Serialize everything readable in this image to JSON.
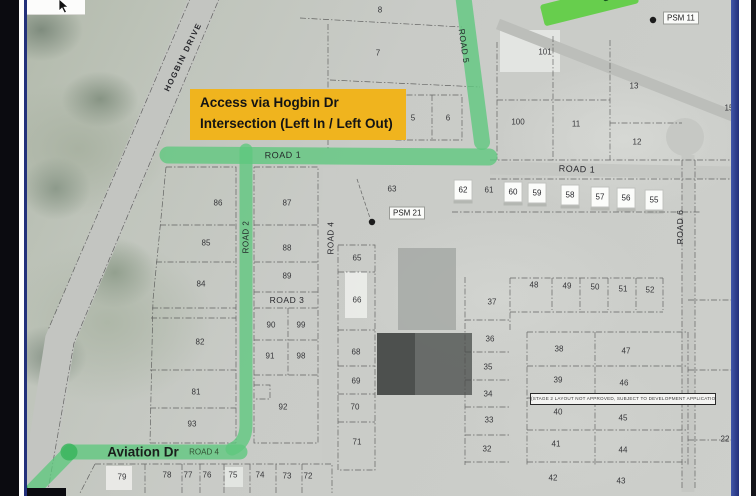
{
  "colors": {
    "highlight_green": "#5EC87D",
    "highlight_green_dark": "#3DB55F",
    "sign_green": "#67CE4D",
    "callout_bg": "#F0B41E",
    "frame_navy": "#22307A"
  },
  "callout": {
    "line1": "Access via Hogbin Dr",
    "line2": "Intersection (Left In / Left Out)"
  },
  "street_sign": {
    "visible_text": "s Rd"
  },
  "note": {
    "text": "(STAGE 2 LAYOUT NOT APPROVED, SUBJECT TO DEVELOPMENT APPLICATION)"
  },
  "map": {
    "road_labels": [
      {
        "text": "HOGBIN DRIVE",
        "x": 183,
        "y": 57,
        "rot": -64,
        "size": 8,
        "weight": 700,
        "ls": 1.4
      },
      {
        "text": "ROAD 5",
        "x": 464,
        "y": 46,
        "rot": 82,
        "size": 8.5,
        "ls": 0.5
      },
      {
        "text": "ROAD 1",
        "x": 283,
        "y": 155,
        "rot": -1,
        "size": 9,
        "ls": 0.5
      },
      {
        "text": "ROAD 1",
        "x": 577,
        "y": 169,
        "rot": 2,
        "size": 9,
        "ls": 0.5
      },
      {
        "text": "ROAD 2",
        "x": 246,
        "y": 237,
        "rot": -90,
        "size": 8,
        "ls": 0.5
      },
      {
        "text": "ROAD 4",
        "x": 331,
        "y": 238,
        "rot": -90,
        "size": 8,
        "ls": 0.5
      },
      {
        "text": "ROAD 3",
        "x": 287,
        "y": 300,
        "rot": 0,
        "size": 8.5,
        "ls": 0.5
      },
      {
        "text": "ROAD 6",
        "x": 680,
        "y": 227,
        "rot": -90,
        "size": 8.5,
        "ls": 0.5
      },
      {
        "text": "Aviation Dr",
        "x": 143,
        "y": 452,
        "rot": 0,
        "size": 13.5,
        "weight": 600,
        "color": "#161616"
      },
      {
        "text": "ROAD 4",
        "x": 204,
        "y": 452,
        "rot": 0,
        "size": 8,
        "color": "#2f4a2f"
      }
    ],
    "psm_markers": [
      {
        "label": "PSM 11",
        "x": 663,
        "y": 18
      },
      {
        "label": "PSM 21",
        "x": 389,
        "y": 213
      }
    ],
    "lots": [
      {
        "n": "8",
        "x": 380,
        "y": 10
      },
      {
        "n": "7",
        "x": 378,
        "y": 53
      },
      {
        "n": "5",
        "x": 413,
        "y": 118
      },
      {
        "n": "6",
        "x": 448,
        "y": 118
      },
      {
        "n": "101",
        "x": 545,
        "y": 52
      },
      {
        "n": "13",
        "x": 634,
        "y": 86
      },
      {
        "n": "100",
        "x": 518,
        "y": 122
      },
      {
        "n": "11",
        "x": 576,
        "y": 124
      },
      {
        "n": "12",
        "x": 637,
        "y": 142
      },
      {
        "n": "15",
        "x": 729,
        "y": 108
      },
      {
        "n": "63",
        "x": 392,
        "y": 189
      },
      {
        "n": "62",
        "x": 463,
        "y": 190,
        "boxed": true
      },
      {
        "n": "61",
        "x": 489,
        "y": 190
      },
      {
        "n": "60",
        "x": 513,
        "y": 192,
        "boxed": true
      },
      {
        "n": "59",
        "x": 537,
        "y": 193,
        "boxed": true
      },
      {
        "n": "58",
        "x": 570,
        "y": 195,
        "boxed": true
      },
      {
        "n": "57",
        "x": 600,
        "y": 197,
        "boxed": true
      },
      {
        "n": "56",
        "x": 626,
        "y": 198,
        "boxed": true
      },
      {
        "n": "55",
        "x": 654,
        "y": 200,
        "boxed": true
      },
      {
        "n": "86",
        "x": 218,
        "y": 203
      },
      {
        "n": "87",
        "x": 287,
        "y": 203
      },
      {
        "n": "85",
        "x": 206,
        "y": 243
      },
      {
        "n": "88",
        "x": 287,
        "y": 248
      },
      {
        "n": "84",
        "x": 201,
        "y": 284
      },
      {
        "n": "89",
        "x": 287,
        "y": 276
      },
      {
        "n": "82",
        "x": 200,
        "y": 342
      },
      {
        "n": "90",
        "x": 271,
        "y": 325
      },
      {
        "n": "99",
        "x": 301,
        "y": 325
      },
      {
        "n": "91",
        "x": 270,
        "y": 356
      },
      {
        "n": "98",
        "x": 301,
        "y": 356
      },
      {
        "n": "81",
        "x": 196,
        "y": 392
      },
      {
        "n": "92",
        "x": 283,
        "y": 407
      },
      {
        "n": "93",
        "x": 192,
        "y": 424
      },
      {
        "n": "65",
        "x": 357,
        "y": 258
      },
      {
        "n": "66",
        "x": 357,
        "y": 300
      },
      {
        "n": "68",
        "x": 356,
        "y": 352
      },
      {
        "n": "69",
        "x": 356,
        "y": 381
      },
      {
        "n": "70",
        "x": 355,
        "y": 407
      },
      {
        "n": "71",
        "x": 357,
        "y": 442
      },
      {
        "n": "79",
        "x": 122,
        "y": 477
      },
      {
        "n": "78",
        "x": 167,
        "y": 475
      },
      {
        "n": "77",
        "x": 188,
        "y": 475
      },
      {
        "n": "76",
        "x": 207,
        "y": 475
      },
      {
        "n": "75",
        "x": 233,
        "y": 475
      },
      {
        "n": "74",
        "x": 260,
        "y": 475
      },
      {
        "n": "73",
        "x": 287,
        "y": 476
      },
      {
        "n": "72",
        "x": 308,
        "y": 476
      },
      {
        "n": "37",
        "x": 492,
        "y": 302
      },
      {
        "n": "48",
        "x": 534,
        "y": 285
      },
      {
        "n": "49",
        "x": 567,
        "y": 286
      },
      {
        "n": "50",
        "x": 595,
        "y": 287
      },
      {
        "n": "51",
        "x": 623,
        "y": 289
      },
      {
        "n": "52",
        "x": 650,
        "y": 290
      },
      {
        "n": "36",
        "x": 490,
        "y": 339
      },
      {
        "n": "38",
        "x": 559,
        "y": 349
      },
      {
        "n": "47",
        "x": 626,
        "y": 351
      },
      {
        "n": "35",
        "x": 488,
        "y": 367
      },
      {
        "n": "39",
        "x": 558,
        "y": 380
      },
      {
        "n": "46",
        "x": 624,
        "y": 383
      },
      {
        "n": "34",
        "x": 488,
        "y": 394
      },
      {
        "n": "40",
        "x": 558,
        "y": 412
      },
      {
        "n": "45",
        "x": 623,
        "y": 418
      },
      {
        "n": "33",
        "x": 489,
        "y": 420
      },
      {
        "n": "41",
        "x": 556,
        "y": 444
      },
      {
        "n": "44",
        "x": 623,
        "y": 450
      },
      {
        "n": "32",
        "x": 487,
        "y": 449
      },
      {
        "n": "42",
        "x": 553,
        "y": 478
      },
      {
        "n": "43",
        "x": 621,
        "y": 481
      },
      {
        "n": "2",
        "x": 735,
        "y": 376
      },
      {
        "n": "22",
        "x": 725,
        "y": 439
      }
    ]
  }
}
